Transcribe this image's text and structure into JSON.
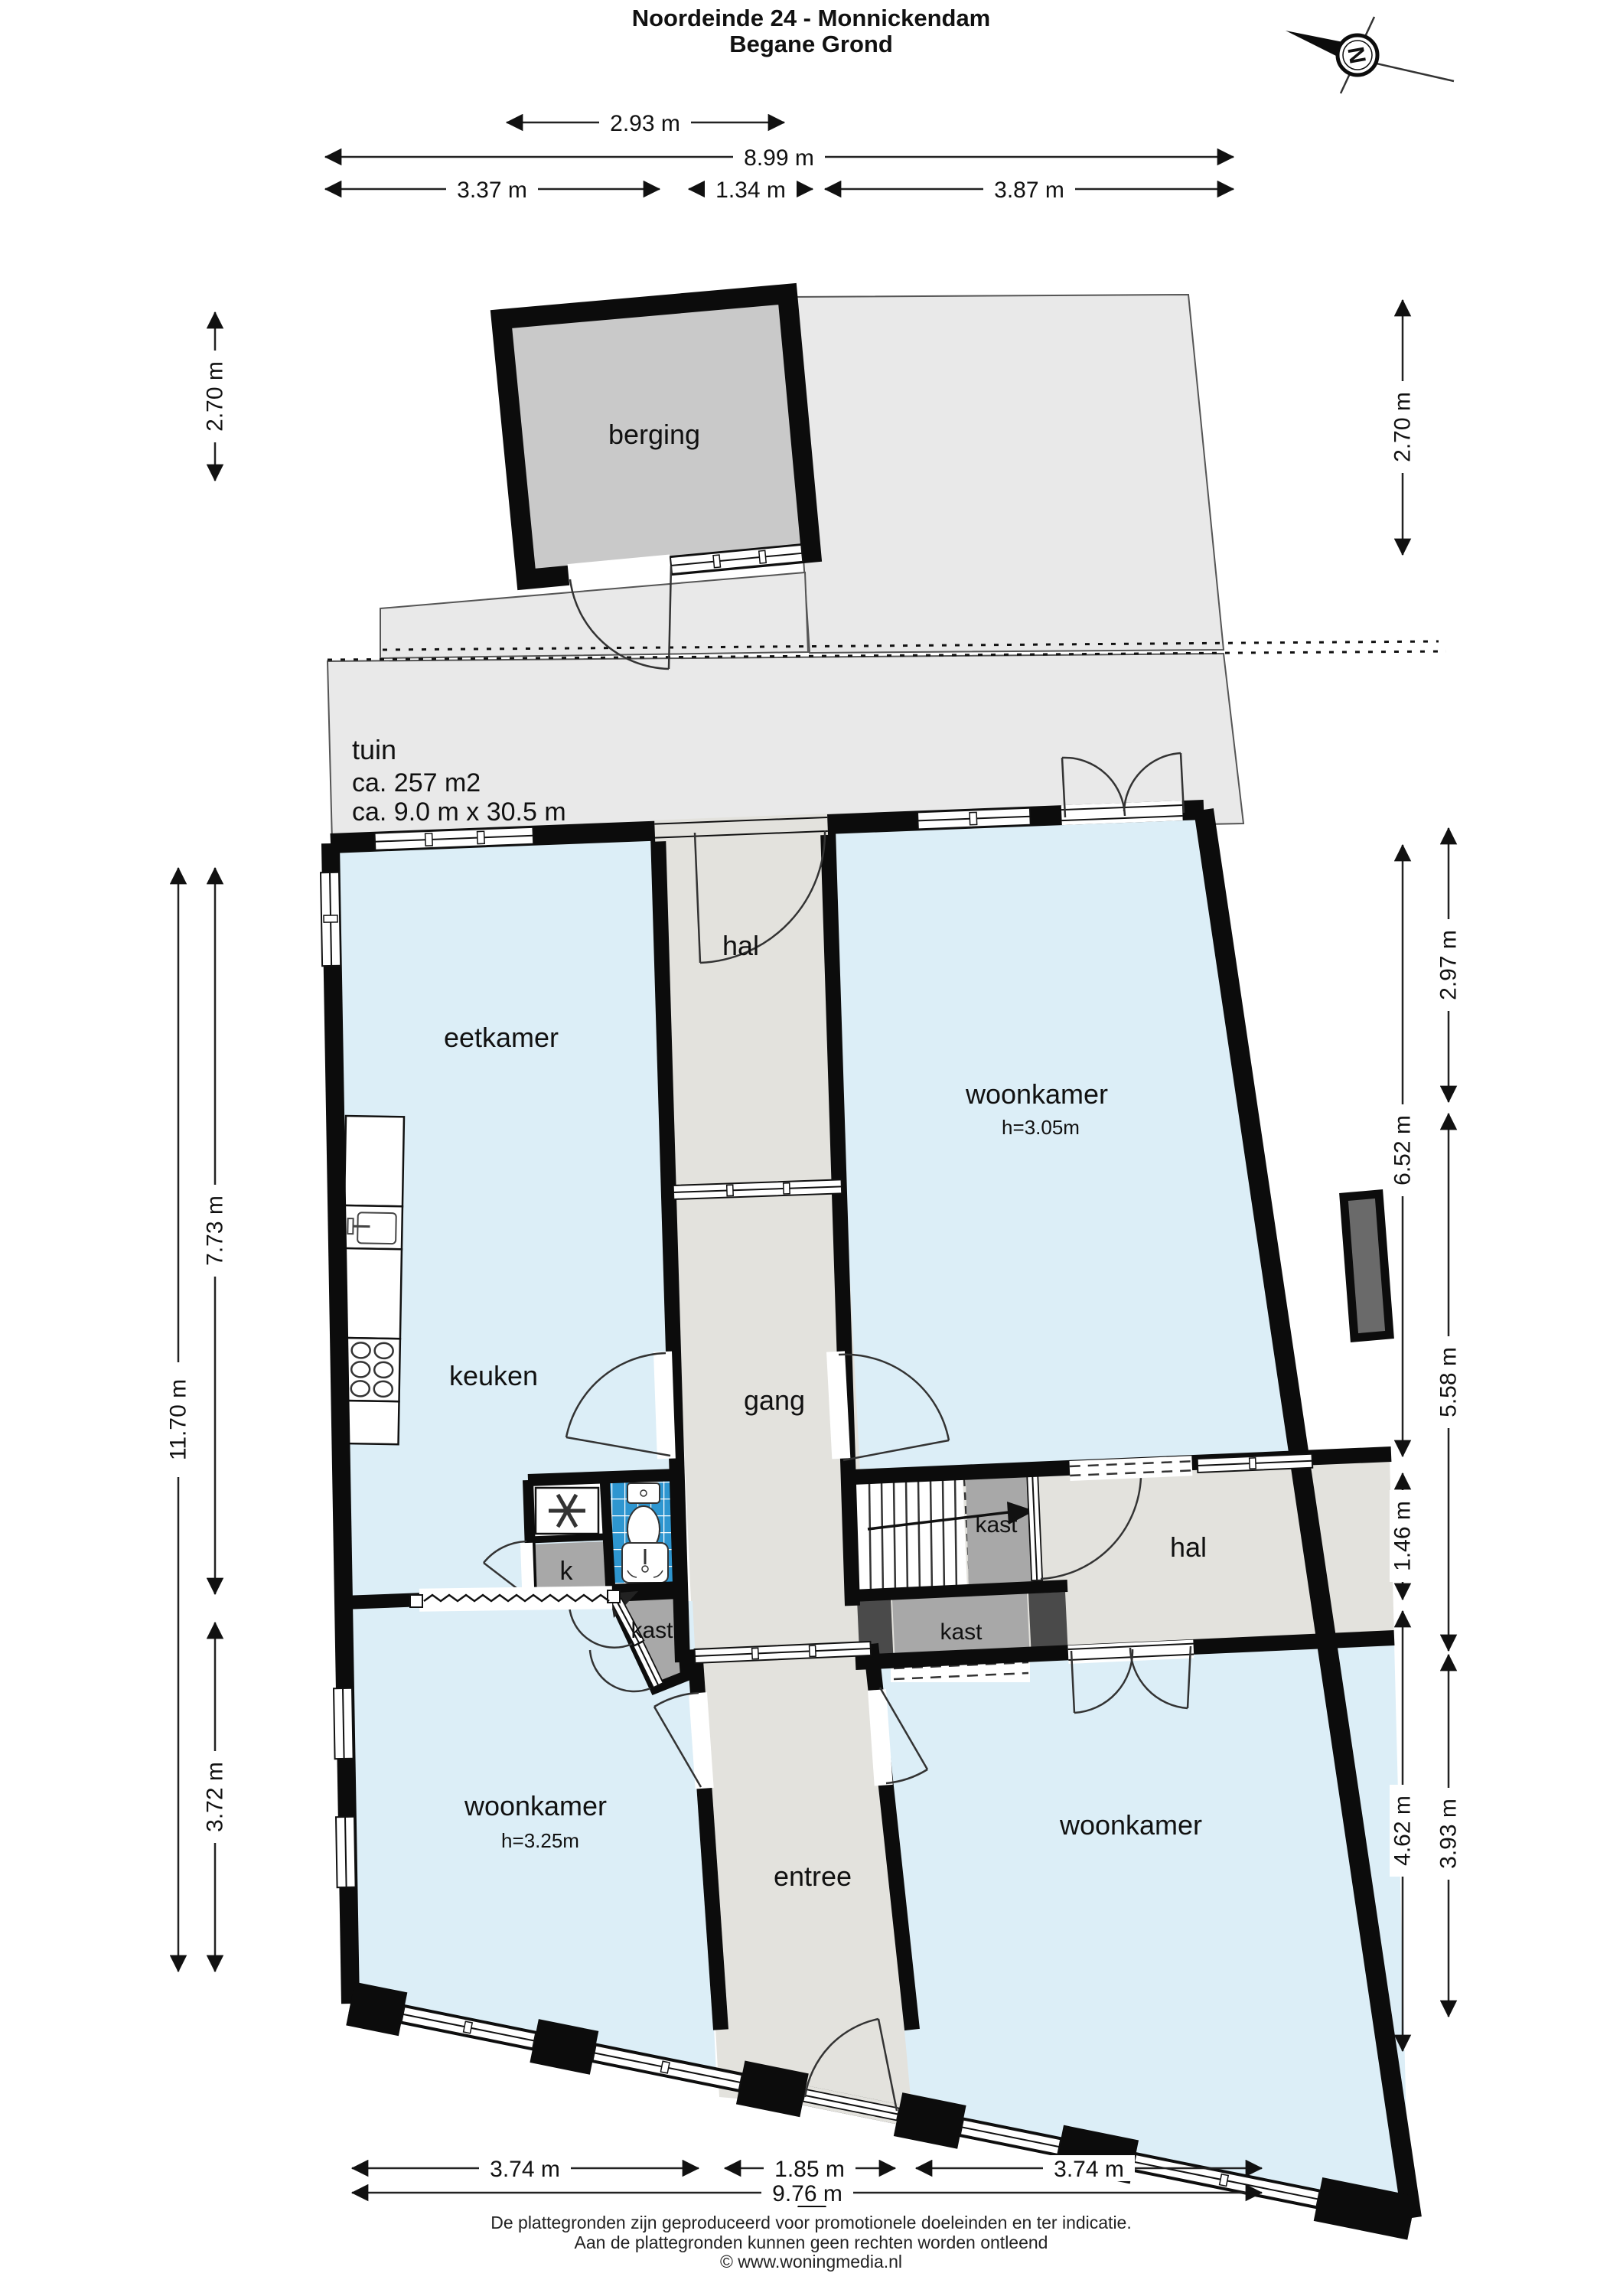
{
  "title": "Noordeinde 24 - Monnickendam",
  "subtitle": "Begane Grond",
  "compass_letter": "N",
  "rooms": {
    "berging": "berging",
    "tuin_name": "tuin",
    "tuin_area": "ca. 257 m2",
    "tuin_size": "ca. 9.0 m x 30.5 m",
    "eetkamer": "eetkamer",
    "hal_boven": "hal",
    "woonkamer_boven": "woonkamer",
    "woonkamer_boven_hoogte": "h=3.05m",
    "keuken": "keuken",
    "gang": "gang",
    "kastje_k": "k",
    "kast_badkamerblok": "kast",
    "kast_bij_trap": "kast",
    "kast_gang": "kast",
    "hal_rechts": "hal",
    "woonkamer_links": "woonkamer",
    "woonkamer_links_hoogte": "h=3.25m",
    "entree": "entree",
    "woonkamer_rechts": "woonkamer"
  },
  "dimensions": {
    "top": [
      "2.93 m",
      "8.99 m",
      "3.37 m",
      "1.34 m",
      "3.87 m"
    ],
    "left": [
      "2.70 m",
      "11.70 m",
      "7.73 m",
      "3.72 m"
    ],
    "right": [
      "2.70 m",
      "6.52 m",
      "1.46 m",
      "4.62 m",
      "2.97 m",
      "5.58 m",
      "3.93 m"
    ],
    "bottom": [
      "3.74 m",
      "1.85 m",
      "3.74 m",
      "9.76 m"
    ]
  },
  "footer": {
    "line1": "De plattegronden zijn geproduceerd voor promotionele doeleinden en ter indicatie.",
    "line2": "Aan de plattegronden kunnen geen rechten worden ontleend",
    "line3": "© www.woningmedia.nl"
  },
  "colors": {
    "room_blue": "#dceef7",
    "hall_gray": "#e3e2dd",
    "closet_gray": "#a8a8a8",
    "dark_gray": "#4a4a4a",
    "tile_blue": "#2e96d0",
    "parcel_gray": "#e9e9e9",
    "berging_gray": "#c9c9c9",
    "wall_black": "#0c0c0c"
  }
}
